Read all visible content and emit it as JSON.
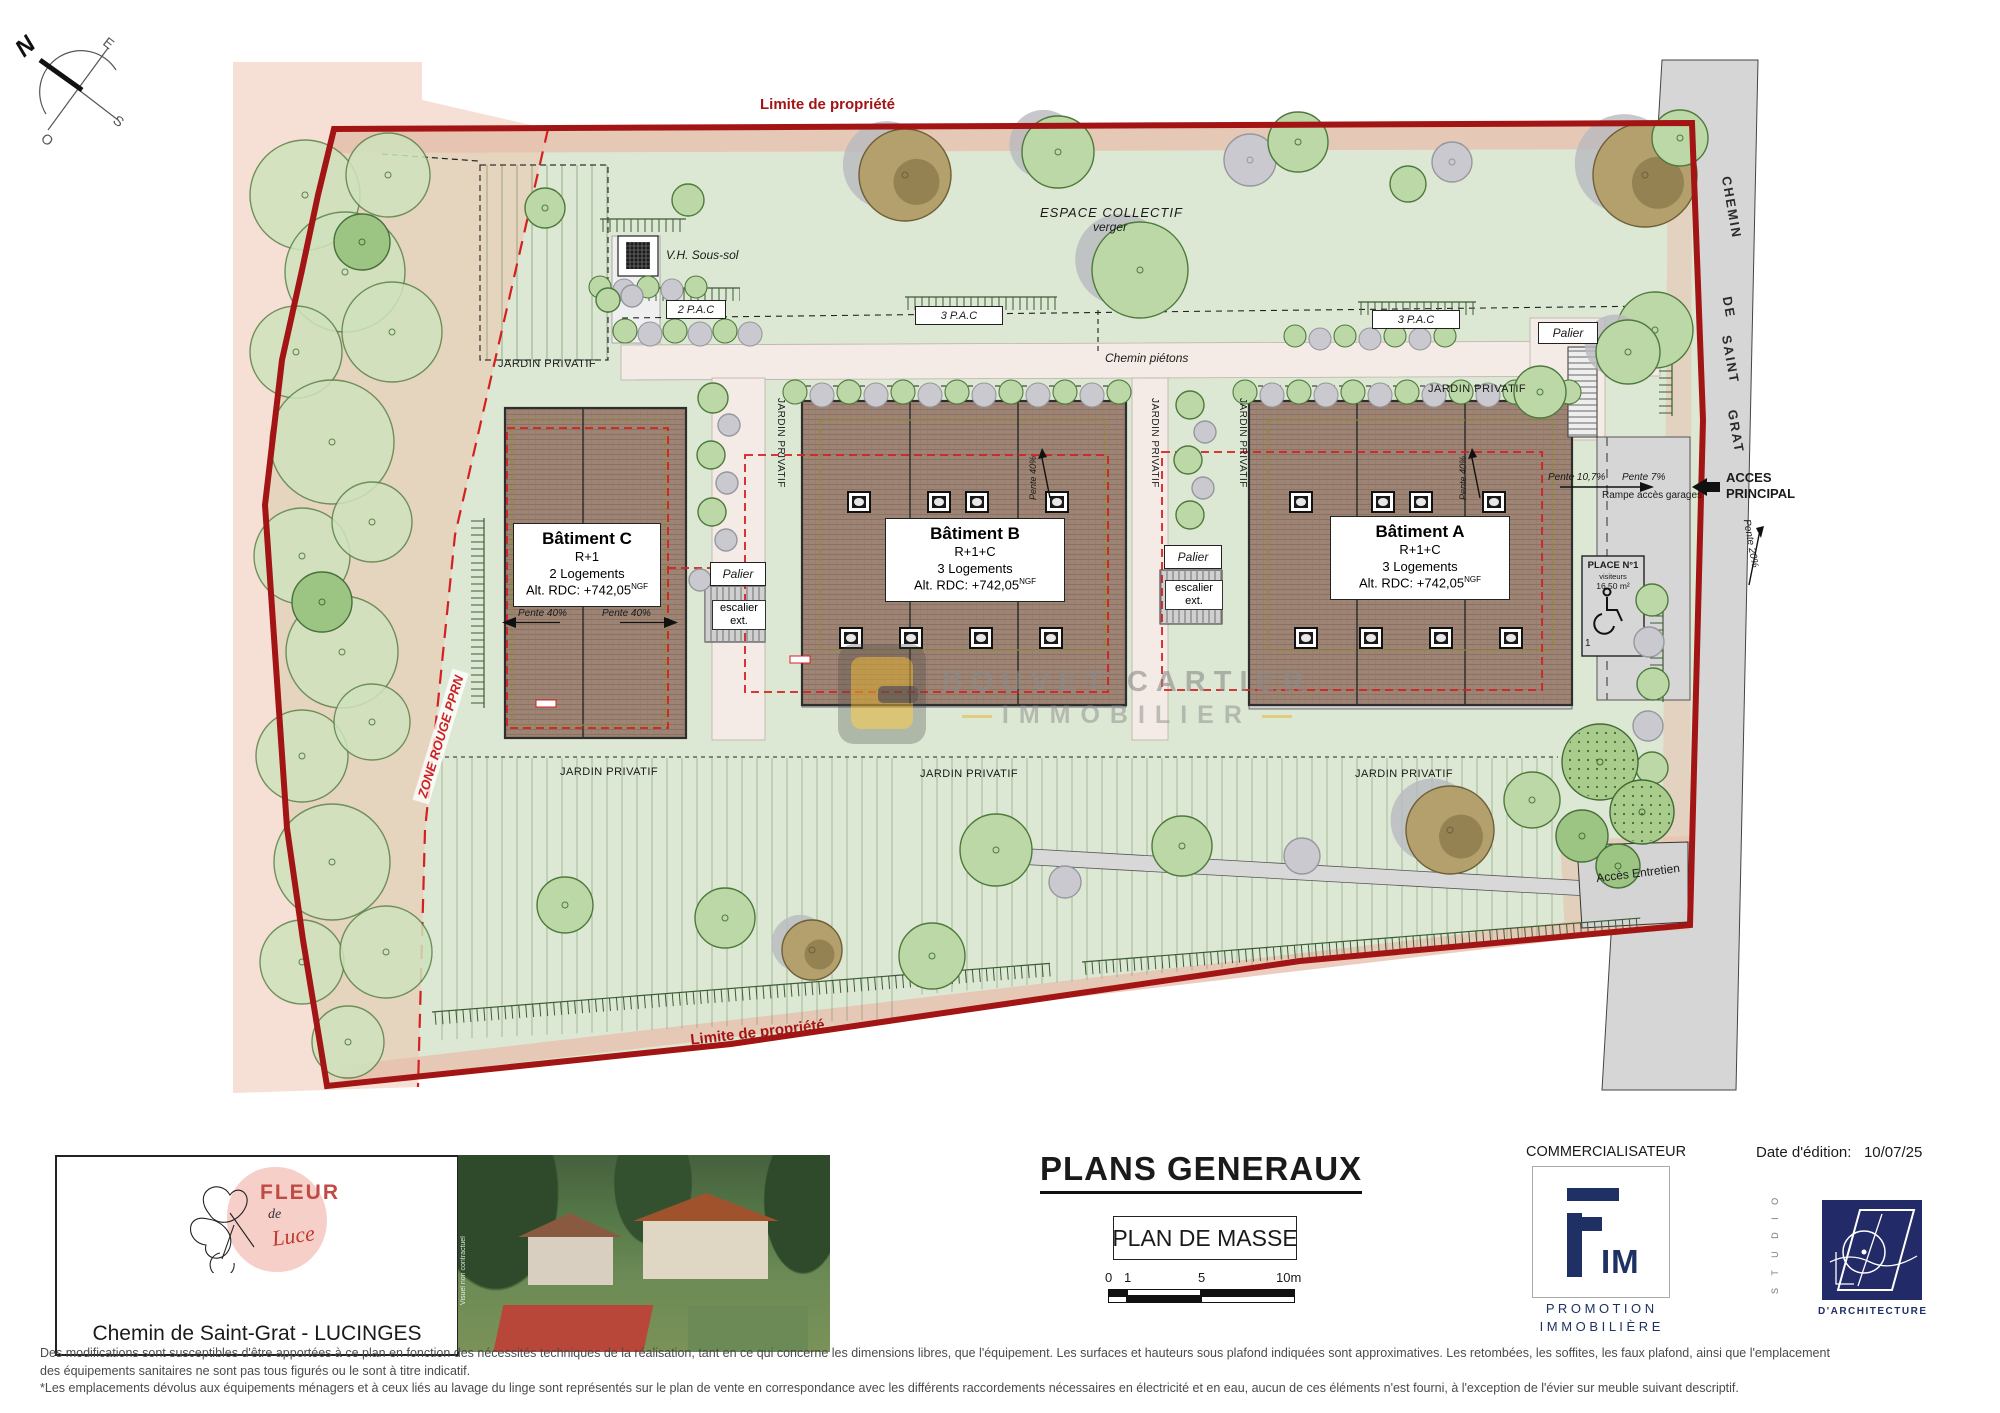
{
  "compass": {
    "n": "N",
    "e": "E",
    "s": "S",
    "o": "O"
  },
  "plan": {
    "property_limit_top": "Limite de propriété",
    "property_limit_bottom": "Limite de propriété",
    "zone_rouge": "ZONE ROUGE PPRN",
    "espace_collectif": "ESPACE COLLECTIF",
    "espace_collectif_sub": "verger",
    "vh_sous_sol": "V.H. Sous-sol",
    "pac_boxes": [
      "2 P.A.C",
      "3 P.A.C",
      "3 P.A.C"
    ],
    "chemin_pietons": "Chemin piétons",
    "jardin_privatif": "JARDIN PRIVATIF",
    "palier": "Palier",
    "escalier_l1": "escalier",
    "escalier_l2": "ext.",
    "pente_40": "Pente 40%",
    "buildings": {
      "c": {
        "name": "Bâtiment C",
        "level": "R+1",
        "units": "2 Logements",
        "alt": "Alt. RDC: +742,05",
        "alt_sup": "NGF"
      },
      "b": {
        "name": "Bâtiment B",
        "level": "R+1+C",
        "units": "3 Logements",
        "alt": "Alt. RDC: +742,05",
        "alt_sup": "NGF"
      },
      "a": {
        "name": "Bâtiment A",
        "level": "R+1+C",
        "units": "3 Logements",
        "alt": "Alt. RDC: +742,05",
        "alt_sup": "NGF"
      }
    },
    "road_name": [
      "CHEMIN",
      "DE",
      "SAINT",
      "GRAT"
    ],
    "acces_principal_l1": "ACCES",
    "acces_principal_l2": "PRINCIPAL",
    "pente_107": "Pente 10,7%",
    "pente_7": "Pente 7%",
    "rampe": "Rampe accès garages",
    "pente_20": "Pente 20%",
    "place": {
      "title": "PLACE N°1",
      "sub": "visiteurs",
      "area": "16,50 m²",
      "num": "1"
    },
    "acces_entretien": "Accès Entretien",
    "watermark_l1": "BOUVET CARTIER",
    "watermark_l2": "IMMOBILIER"
  },
  "footer": {
    "brand": {
      "fleur": "FLEUR",
      "de": "de",
      "luce": "Luce"
    },
    "address": "Chemin de Saint-Grat - LUCINGES",
    "photo_note": "Visuel non contractuel",
    "title": "PLANS GENERAUX",
    "subtitle": "PLAN DE MASSE",
    "scale_ticks": [
      "0",
      "1",
      "5",
      "10m"
    ],
    "commercialisateur": "COMMERCIALISATEUR",
    "fim_logo_text": "IM",
    "fim_line1": "P R O M O T I O N",
    "fim_line2": "I M M O B I L I È R E",
    "date_label": "Date d'édition:",
    "date_value": "10/07/25",
    "studio_vertical": "S T U D I O",
    "studio_bottom": "D'ARCHITECTURE"
  },
  "disclaimer": {
    "lines": [
      "Des modifications sont susceptibles d'être apportées à ce plan en fonction des nécessités techniques de la réalisation, tant en ce qui concerne les dimensions libres, que l'équipement. Les surfaces et hauteurs sous plafond indiquées sont approximatives. Les retombées, les soffites, les faux plafond, ainsi que l'emplacement",
      "des équipements sanitaires ne sont pas tous figurés ou le sont à titre indicatif.",
      "*Les emplacements dévolus aux équipements ménagers et à ceux liés au lavage du linge sont représentés sur le plan de vente en correspondance avec les différents raccordements nécessaires en électricité et en eau, aucun de ces éléments n'est fourni, à l'exception de l'évier sur meuble suivant descriptif."
    ]
  },
  "colors": {
    "property_line": "#a31414",
    "accent_red": "#d42020",
    "navy": "#1e3064",
    "ground": "#dce8d3",
    "road": "#d6d6d6",
    "building": "#9d8474",
    "gold": "#e5b63a"
  }
}
